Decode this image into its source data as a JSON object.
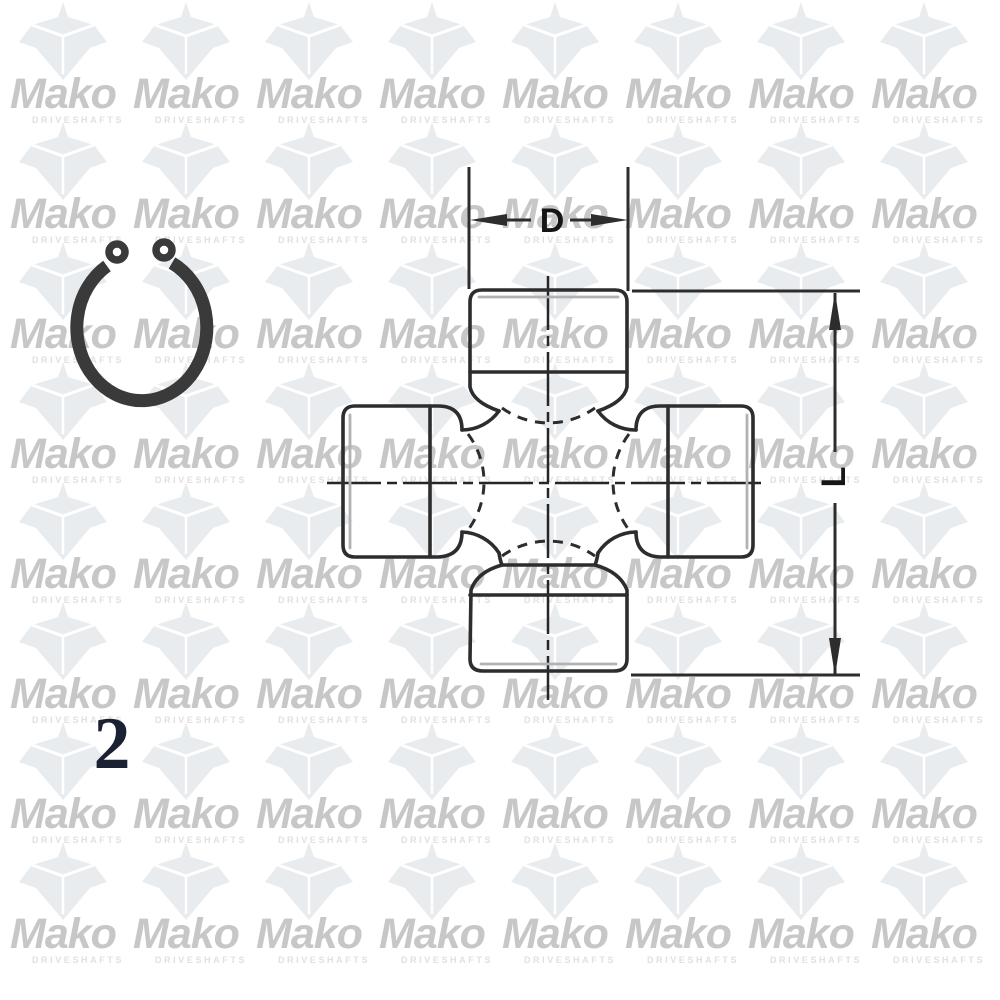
{
  "page": {
    "background_color": "#ffffff"
  },
  "watermark": {
    "brand": "Mako",
    "tagline": "DRIVESHAFTS",
    "brand_color": "#c7c7c7",
    "tagline_color": "#e3e0dd",
    "logo_color": "#e9ecef",
    "logo_accent_color": "#ffffff"
  },
  "figure": {
    "number": "2",
    "number_color": "#1a2133"
  },
  "drawing": {
    "type": "technical-line-drawing",
    "subject": "universal-joint-cross-and-snap-ring",
    "line_color": "#2d2d2d",
    "snap_ring_color": "#3a3a3a",
    "dimension_labels": [
      {
        "label": "D"
      },
      {
        "label": "L"
      }
    ]
  }
}
